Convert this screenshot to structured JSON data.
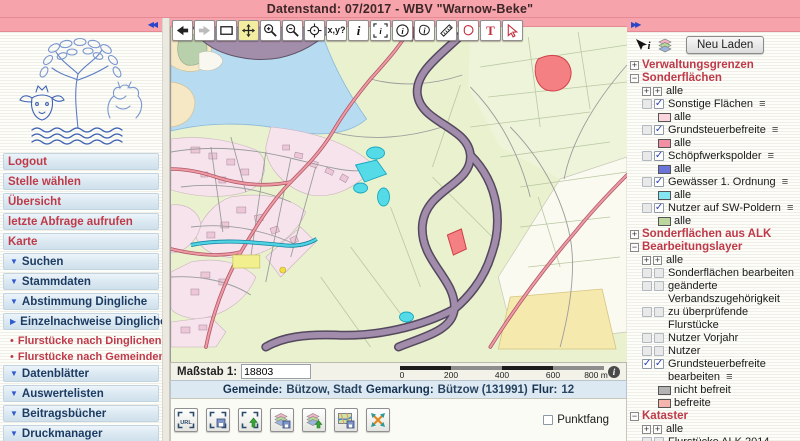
{
  "header": {
    "title": "Datenstand: 07/2017 - WBV \"Warnow-Beke\""
  },
  "sidebar": {
    "collapse_glyph": "◀◀",
    "items": [
      {
        "type": "link",
        "label": "Logout"
      },
      {
        "type": "link",
        "label": "Stelle wählen"
      },
      {
        "type": "link",
        "label": "Übersicht"
      },
      {
        "type": "link",
        "label": "letzte Abfrage aufrufen"
      },
      {
        "type": "link",
        "label": "Karte"
      },
      {
        "type": "section",
        "label": "Suchen",
        "arrow": "▼"
      },
      {
        "type": "section",
        "label": "Stammdaten",
        "arrow": "▼"
      },
      {
        "type": "section",
        "label": "Abstimmung Dingliche",
        "arrow": "▼"
      },
      {
        "type": "section",
        "label": "Einzelnachweise Dingliche",
        "arrow": "▶"
      },
      {
        "type": "sublink",
        "label": "Flurstücke nach Dinglichen",
        "bullet": "•"
      },
      {
        "type": "sublink",
        "label": "Flurstücke nach Gemeinden",
        "bullet": "•"
      },
      {
        "type": "section",
        "label": "Datenblätter",
        "arrow": "▼"
      },
      {
        "type": "section",
        "label": "Auswertelisten",
        "arrow": "▼"
      },
      {
        "type": "section",
        "label": "Beitragsbücher",
        "arrow": "▼"
      },
      {
        "type": "section",
        "label": "Druckmanager",
        "arrow": "▼"
      }
    ]
  },
  "toolbar": {
    "buttons": [
      {
        "name": "back"
      },
      {
        "name": "forward"
      },
      {
        "name": "full-extent"
      },
      {
        "name": "pan",
        "active": true
      },
      {
        "name": "zoom-in"
      },
      {
        "name": "zoom-out"
      },
      {
        "name": "center"
      },
      {
        "name": "coords",
        "label": "x,y?"
      },
      {
        "name": "info",
        "label": "i"
      },
      {
        "name": "info-select",
        "label": "i"
      },
      {
        "name": "info-circle",
        "label": "i"
      },
      {
        "name": "info-polygon",
        "label": "i"
      },
      {
        "name": "measure"
      },
      {
        "name": "area-polygon"
      },
      {
        "name": "text",
        "label": "T"
      },
      {
        "name": "select-arrow"
      }
    ]
  },
  "map": {
    "scale_label": "Maßstab 1:",
    "scale_value": "18803",
    "scalebar_ticks": [
      "0",
      "200",
      "400",
      "600",
      "800 m"
    ],
    "info_glyph": "i",
    "status": {
      "gemeinde_label": "Gemeinde:",
      "gemeinde": "Bützow, Stadt",
      "gemarkung_label": "Gemarkung:",
      "gemarkung": "Bützow (131991)",
      "flur_label": "Flur:",
      "flur": "12"
    },
    "punktfang_label": "Punktfang",
    "map_colors": {
      "fields": "#e9f1cf",
      "lake": "#b7dcf2",
      "forest": "#a28dab",
      "river": "#a18cab",
      "road_red": "#ee9aa4",
      "water_cyan": "#55dbe8",
      "town": "#f6e3ec",
      "special_red": "#f58084",
      "parcel_yellow": "#f5e9ad"
    }
  },
  "bottom_toolbar": {
    "buttons": [
      {
        "name": "extent-url",
        "label": "URL"
      },
      {
        "name": "extent-save"
      },
      {
        "name": "extent-load"
      },
      {
        "name": "layers-save"
      },
      {
        "name": "layers-load"
      },
      {
        "name": "map-save"
      },
      {
        "name": "map-full-extent"
      }
    ],
    "punktfang_checked": false
  },
  "panel": {
    "expand_glyph": "▶▶",
    "reload_button": "Neu Laden",
    "menu_glyph": "≡",
    "check_glyph": "✓",
    "alle_box_glyph": "+",
    "tree": [
      {
        "label": "Verwaltungsgrenzen",
        "type": "header",
        "expander": "+"
      },
      {
        "label": "Sonderflächen",
        "type": "header",
        "expander": "−"
      },
      {
        "label": "alle",
        "type": "alle"
      },
      {
        "label": "Sonstige Flächen",
        "type": "layer",
        "query_checked": false,
        "checked": true,
        "menu": true
      },
      {
        "label": "alle",
        "type": "legend",
        "color": "#fbd5de"
      },
      {
        "label": "Grundsteuerbefreite",
        "type": "layer",
        "query_checked": false,
        "checked": true,
        "menu": true
      },
      {
        "label": "alle",
        "type": "legend",
        "color": "#f28fa4"
      },
      {
        "label": "Schöpfwerkspolder",
        "type": "layer",
        "query_checked": false,
        "checked": true,
        "menu": true
      },
      {
        "label": "alle",
        "type": "legend",
        "color": "#6b74d8"
      },
      {
        "label": "Gewässer 1. Ordnung",
        "type": "layer",
        "query_checked": false,
        "checked": true,
        "menu": true
      },
      {
        "label": "alle",
        "type": "legend",
        "color": "#83e6f0"
      },
      {
        "label": "Nutzer auf SW-Poldern",
        "type": "layer",
        "query_checked": false,
        "checked": true,
        "menu": true
      },
      {
        "label": "alle",
        "type": "legend",
        "color": "#bcd79d"
      },
      {
        "label": "Sonderflächen aus ALK",
        "type": "header",
        "expander": "+"
      },
      {
        "label": "Bearbeitungslayer",
        "type": "header",
        "expander": "−"
      },
      {
        "label": "alle",
        "type": "alle"
      },
      {
        "label": "Sonderflächen bearbeiten",
        "type": "layer",
        "query_checked": false,
        "checked": false
      },
      {
        "label": "geänderte Verbandszugehörigkeit",
        "type": "layer",
        "query_checked": false,
        "checked": false
      },
      {
        "label": "zu überprüfende Flurstücke",
        "type": "layer",
        "query_checked": false,
        "checked": false
      },
      {
        "label": "Nutzer Vorjahr",
        "type": "layer",
        "query_checked": false,
        "checked": false
      },
      {
        "label": "Nutzer",
        "type": "layer",
        "query_checked": false,
        "checked": false
      },
      {
        "label": "Grundsteuerbefreite bearbeiten",
        "type": "layer",
        "query_checked": true,
        "checked": true,
        "menu": true
      },
      {
        "label": "nicht befreit",
        "type": "legend",
        "color": "#b3b3b3"
      },
      {
        "label": "befreite",
        "type": "legend",
        "color": "#f5b5ad"
      },
      {
        "label": "Kataster",
        "type": "header",
        "expander": "−"
      },
      {
        "label": "alle",
        "type": "alle"
      },
      {
        "label": "Flurstücke ALK 2014",
        "type": "layer",
        "query_checked": false,
        "checked": false
      },
      {
        "label": "Flurstücke ALKIS",
        "type": "layer",
        "query_checked": false,
        "checked": false
      }
    ]
  }
}
